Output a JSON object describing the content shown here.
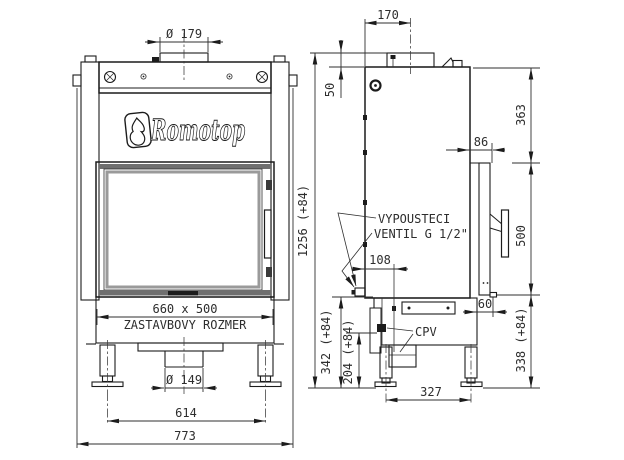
{
  "drawing": {
    "brand": "Romotop",
    "front_view": {
      "flue_diameter": "Ø 179",
      "glass_size": "660 x 500",
      "glass_caption": "ZASTAVBOVY ROZMER",
      "outlet_diameter": "Ø 149",
      "leg_span": "614",
      "overall_width": "773",
      "overall_height": "1256 (+84)"
    },
    "side_view": {
      "flue_offset": "170",
      "collar_drop": "50",
      "top_to_door": "363",
      "door_depth": "86",
      "door_height": "500",
      "valve_note_line1": "VYPOUSTECI",
      "valve_note_line2": "VENTIL G 1/2\"",
      "valve_offset": "108",
      "door_gap": "60",
      "cpv_label": "CPV",
      "valve_height": "342 (+84)",
      "cpv_height": "204 (+84)",
      "leg_spacing": "327",
      "door_bottom_height": "338 (+84)"
    },
    "colors": {
      "line": "#1c1c1c",
      "dim_text": "#2d2d2d",
      "band_gray": "#6f6f6f",
      "glass_gray": "#9a9a9a",
      "background": "#ffffff"
    }
  }
}
